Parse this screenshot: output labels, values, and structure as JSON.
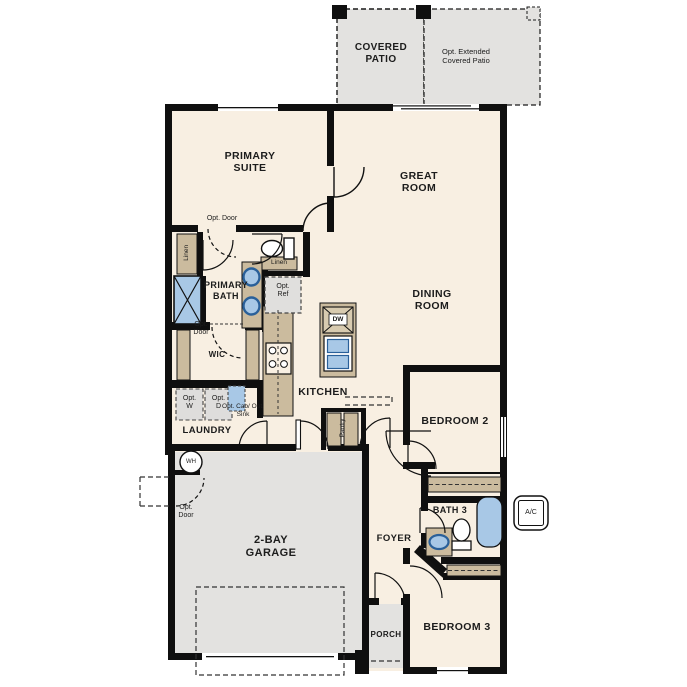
{
  "plan_title": "single-story-floor-plan",
  "colors": {
    "floor": "#f8efe2",
    "patio_gray": "#e3e2e0",
    "cabinet_tan": "#cbbb9e",
    "fixture_blue": "#a8c8e6",
    "fixture_ring_blue": "#2a6099",
    "wall_black": "#0f0f0f"
  },
  "rooms": {
    "covered_patio": "COVERED PATIO",
    "extended_patio": "Opt. Extended Covered Patio",
    "primary_suite": "PRIMARY SUITE",
    "great_room": "GREAT ROOM",
    "dining_room": "DINING ROOM",
    "primary_bath": "PRIMARY BATH",
    "wic": "WIC",
    "kitchen": "KITCHEN",
    "laundry": "LAUNDRY",
    "pantry": "Pantry",
    "bedroom_2": "BEDROOM 2",
    "bath_3": "BATH 3",
    "foyer": "FOYER",
    "garage": "2-BAY GARAGE",
    "porch": "PORCH",
    "bedroom_3": "BEDROOM 3"
  },
  "annotations": {
    "opt_door": "Opt. Door",
    "linen": "Linen",
    "opt_ref": "Opt. Ref",
    "opt_washer": "Opt. W",
    "opt_dryer": "Opt. D",
    "opt_cab_sink": "Opt. Cab/ Opt. Sink",
    "dishwasher": "DW",
    "water_heater": "WH",
    "ac_unit": "A/C"
  }
}
